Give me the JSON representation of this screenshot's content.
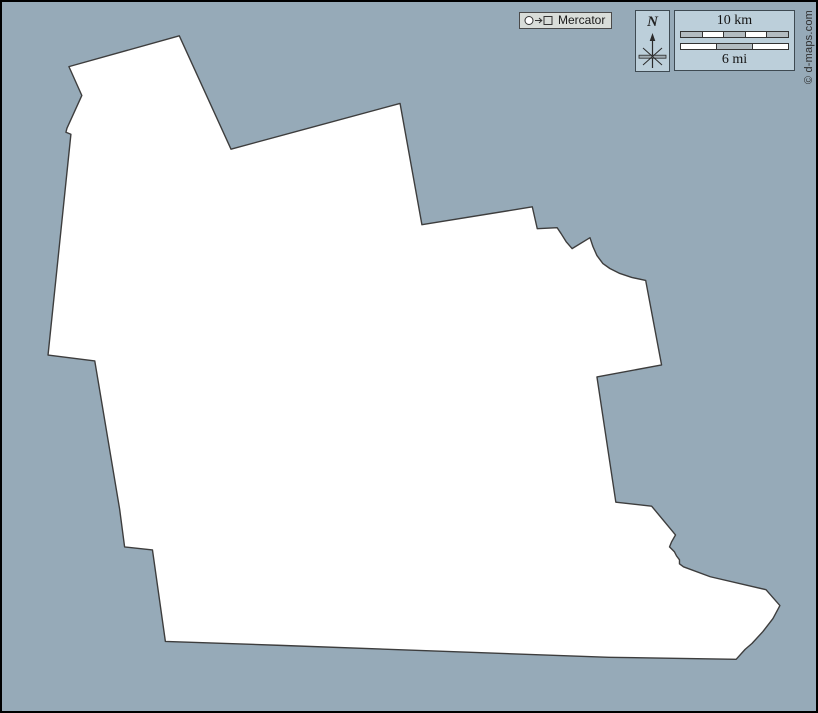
{
  "map": {
    "ocean_color": "#96aab8",
    "region_fill": "#ffffff",
    "outline_color": "#3d3d3d",
    "outline_points": "178,34 230,148 400,102 422,224 533,206 538,228 558,227 562,233 567,241 573,248 591,237 594,246 598,255 604,263 611,268 621,273 633,277 647,280 663,365 598,377 617,503 653,507 677,536 673,543 671,548 676,553 678,557 681,561 681,565 685,568 712,578 768,591 782,607 775,620 765,633 754,645 747,651 738,661 610,659 280,647 164,643 151,551 123,548 118,510 93,361 46,355 69,133 64,131 65,127 80,94 67,65"
  },
  "projection_badge": {
    "icon": "circle-to-square-projection-icon",
    "label": "Mercator"
  },
  "compass": {
    "label": "N",
    "icon": "north-arrow-star-icon"
  },
  "scale_bar": {
    "km_label": "10 km",
    "mi_label": "6 mi",
    "km_segments": [
      "gray",
      "white",
      "gray",
      "white",
      "gray"
    ],
    "mi_segments": [
      "white",
      "gray",
      "white"
    ],
    "segment_gray": "#b3bcc1",
    "segment_white": "#ffffff"
  },
  "copyright": "© d-maps.com"
}
